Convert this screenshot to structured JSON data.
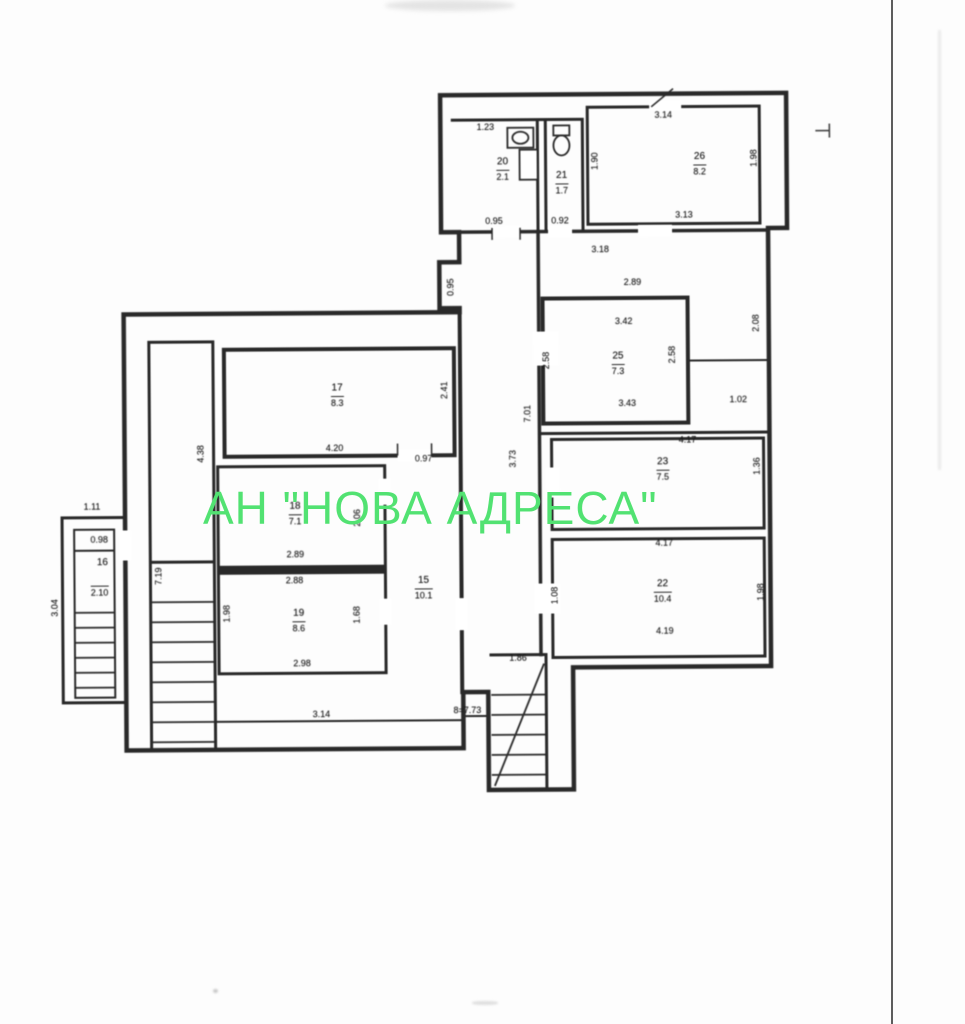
{
  "watermark": {
    "text": "АН \"НОВА АДРЕСА\"",
    "color": "#52e272"
  },
  "plan": {
    "ink_color": "#2d2d2d",
    "labels": [
      {
        "kind": "dim",
        "text": "1.23",
        "x": 488,
        "y": 127
      },
      {
        "kind": "room",
        "text": "20",
        "x": 505,
        "y": 162
      },
      {
        "kind": "area",
        "text": "2.1",
        "x": 505,
        "y": 176
      },
      {
        "kind": "dim",
        "text": "0.95",
        "x": 496,
        "y": 221
      },
      {
        "kind": "dim",
        "text": "0.92",
        "x": 562,
        "y": 221
      },
      {
        "kind": "room",
        "text": "21",
        "x": 564,
        "y": 176
      },
      {
        "kind": "area",
        "text": "1.7",
        "x": 564,
        "y": 190
      },
      {
        "kind": "dim",
        "text": "3.14",
        "x": 666,
        "y": 116
      },
      {
        "kind": "room",
        "text": "26",
        "x": 702,
        "y": 158
      },
      {
        "kind": "area",
        "text": "8.2",
        "x": 702,
        "y": 172
      },
      {
        "kind": "dim",
        "text": "1.90",
        "x": 597,
        "y": 162,
        "rot": -90
      },
      {
        "kind": "dim",
        "text": "1.98",
        "x": 756,
        "y": 160,
        "rot": -90
      },
      {
        "kind": "dim",
        "text": "3.13",
        "x": 686,
        "y": 216
      },
      {
        "kind": "dim",
        "text": "3.18",
        "x": 602,
        "y": 250
      },
      {
        "kind": "dim",
        "text": "0.95",
        "x": 452,
        "y": 287,
        "rot": -90
      },
      {
        "kind": "dim",
        "text": "2.89",
        "x": 634,
        "y": 283
      },
      {
        "kind": "dim",
        "text": "3.42",
        "x": 625,
        "y": 322
      },
      {
        "kind": "room",
        "text": "25",
        "x": 619,
        "y": 357
      },
      {
        "kind": "area",
        "text": "7.3",
        "x": 619,
        "y": 371
      },
      {
        "kind": "dim",
        "text": "2.58",
        "x": 547,
        "y": 361,
        "rot": -90
      },
      {
        "kind": "dim",
        "text": "2.58",
        "x": 673,
        "y": 356,
        "rot": -90
      },
      {
        "kind": "dim",
        "text": "2.08",
        "x": 757,
        "y": 325,
        "rot": -90
      },
      {
        "kind": "dim",
        "text": "3.43",
        "x": 628,
        "y": 404
      },
      {
        "kind": "dim",
        "text": "1.02",
        "x": 739,
        "y": 401
      },
      {
        "kind": "dim",
        "text": "7.01",
        "x": 528,
        "y": 414,
        "rot": -90
      },
      {
        "kind": "dim",
        "text": "3.73",
        "x": 513,
        "y": 459,
        "rot": -90
      },
      {
        "kind": "dim",
        "text": "4.17",
        "x": 688,
        "y": 441
      },
      {
        "kind": "room",
        "text": "23",
        "x": 663,
        "y": 463
      },
      {
        "kind": "area",
        "text": "7.5",
        "x": 663,
        "y": 477
      },
      {
        "kind": "dim",
        "text": "1.36",
        "x": 757,
        "y": 468,
        "rot": -90
      },
      {
        "kind": "dim",
        "text": "4.17",
        "x": 664,
        "y": 544
      },
      {
        "kind": "room",
        "text": "22",
        "x": 662,
        "y": 585
      },
      {
        "kind": "area",
        "text": "10.4",
        "x": 662,
        "y": 599
      },
      {
        "kind": "dim",
        "text": "1.98",
        "x": 760,
        "y": 594,
        "rot": -90
      },
      {
        "kind": "dim",
        "text": "4.19",
        "x": 664,
        "y": 632
      },
      {
        "kind": "dim",
        "text": "1.08",
        "x": 554,
        "y": 596,
        "rot": -90
      },
      {
        "kind": "dim",
        "text": "4.38",
        "x": 201,
        "y": 452,
        "rot": -90
      },
      {
        "kind": "dim",
        "text": "7.19",
        "x": 158,
        "y": 574,
        "rot": -90
      },
      {
        "kind": "room",
        "text": "17",
        "x": 338,
        "y": 387
      },
      {
        "kind": "area",
        "text": "8.3",
        "x": 338,
        "y": 401
      },
      {
        "kind": "dim",
        "text": "2.41",
        "x": 445,
        "y": 390,
        "rot": -90
      },
      {
        "kind": "dim",
        "text": "4.20",
        "x": 335,
        "y": 447
      },
      {
        "kind": "dim",
        "text": "0.97",
        "x": 424,
        "y": 458
      },
      {
        "kind": "room",
        "text": "18",
        "x": 295,
        "y": 505
      },
      {
        "kind": "area",
        "text": "7.1",
        "x": 295,
        "y": 519
      },
      {
        "kind": "dim",
        "text": "2.06",
        "x": 357,
        "y": 517,
        "rot": -90
      },
      {
        "kind": "dim",
        "text": "2.89",
        "x": 295,
        "y": 553
      },
      {
        "kind": "dim",
        "text": "2.88",
        "x": 294,
        "y": 579
      },
      {
        "kind": "room",
        "text": "19",
        "x": 298,
        "y": 612
      },
      {
        "kind": "area",
        "text": "8.6",
        "x": 298,
        "y": 626
      },
      {
        "kind": "dim",
        "text": "1.98",
        "x": 226,
        "y": 612,
        "rot": -90
      },
      {
        "kind": "dim",
        "text": "1.68",
        "x": 356,
        "y": 614,
        "rot": -90
      },
      {
        "kind": "dim",
        "text": "2.98",
        "x": 301,
        "y": 662
      },
      {
        "kind": "room",
        "text": "15",
        "x": 423,
        "y": 580
      },
      {
        "kind": "area",
        "text": "10.1",
        "x": 423,
        "y": 594
      },
      {
        "kind": "dim",
        "text": "1.11",
        "x": 92,
        "y": 504
      },
      {
        "kind": "dim",
        "text": "0.98",
        "x": 99,
        "y": 537
      },
      {
        "kind": "room",
        "text": "16",
        "x": 102,
        "y": 560
      },
      {
        "kind": "area",
        "text": "2.10",
        "x": 99,
        "y": 589
      },
      {
        "kind": "dim",
        "text": "3.04",
        "x": 54,
        "y": 605,
        "rot": -90
      },
      {
        "kind": "dim",
        "text": "3.14",
        "x": 320,
        "y": 713
      },
      {
        "kind": "dim",
        "text": "8=7.73",
        "x": 466,
        "y": 710
      },
      {
        "kind": "dim",
        "text": "1.86",
        "x": 517,
        "y": 658
      }
    ]
  }
}
